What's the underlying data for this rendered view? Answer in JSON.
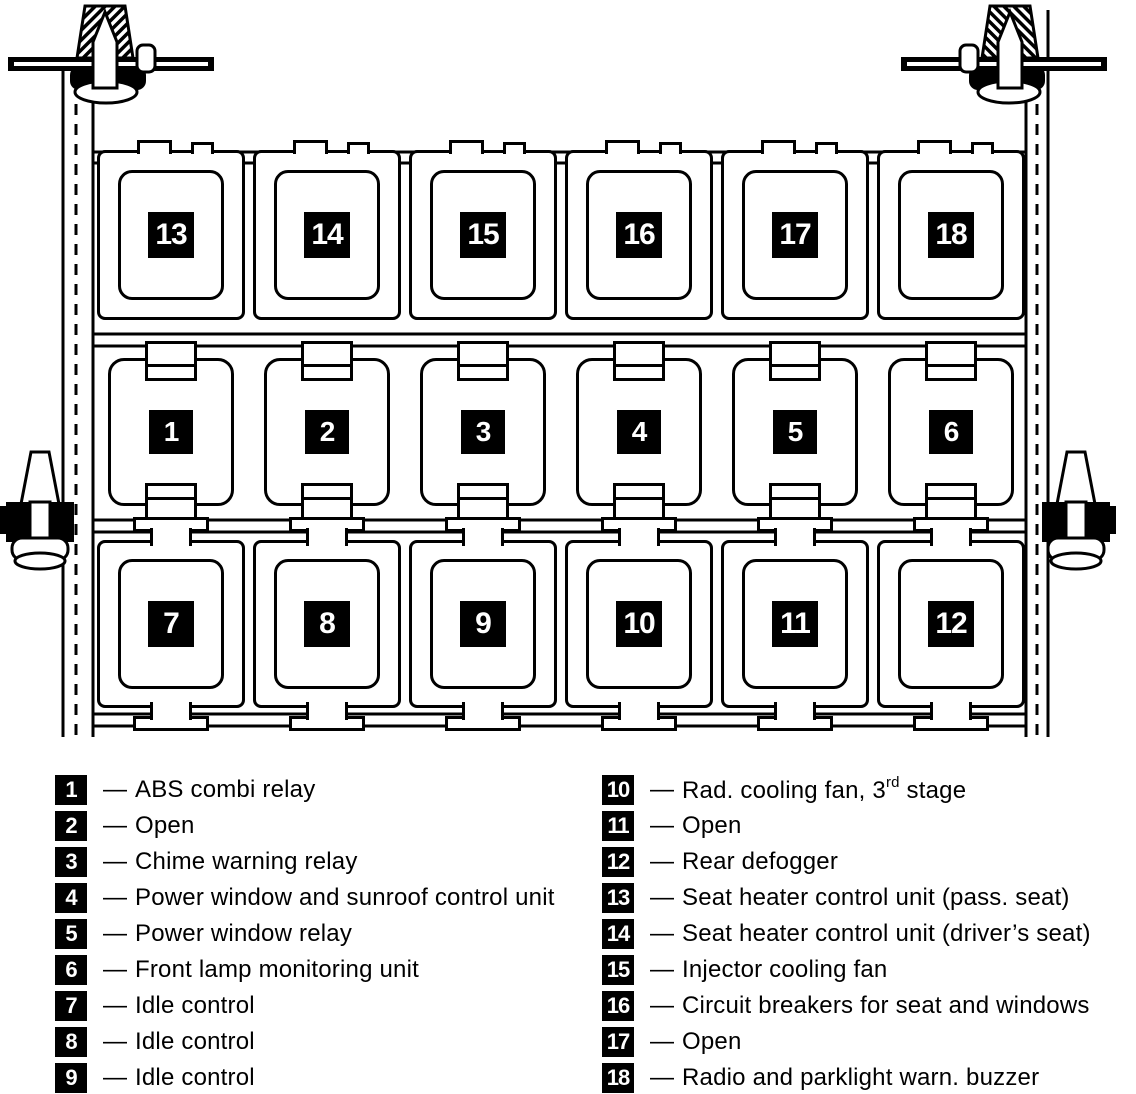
{
  "diagram": {
    "rows": [
      {
        "id": "top-row",
        "numbers": [
          "13",
          "14",
          "15",
          "16",
          "17",
          "18"
        ]
      },
      {
        "id": "middle-row",
        "numbers": [
          "1",
          "2",
          "3",
          "4",
          "5",
          "6"
        ]
      },
      {
        "id": "bottom-row",
        "numbers": [
          "7",
          "8",
          "9",
          "10",
          "11",
          "12"
        ]
      }
    ]
  },
  "legend": {
    "dash": "—",
    "columns": [
      {
        "items": [
          {
            "num": "1",
            "label": "ABS combi relay"
          },
          {
            "num": "2",
            "label": "Open"
          },
          {
            "num": "3",
            "label": "Chime warning relay"
          },
          {
            "num": "4",
            "label": "Power window and sunroof control unit"
          },
          {
            "num": "5",
            "label": "Power window relay"
          },
          {
            "num": "6",
            "label": "Front lamp monitoring unit"
          },
          {
            "num": "7",
            "label": "Idle control"
          },
          {
            "num": "8",
            "label": "Idle control"
          },
          {
            "num": "9",
            "label": "Idle control"
          }
        ]
      },
      {
        "items": [
          {
            "num": "10",
            "pre": "Rad. cooling fan, 3",
            "sup": "rd",
            "post": " stage"
          },
          {
            "num": "11",
            "label": "Open"
          },
          {
            "num": "12",
            "label": "Rear defogger"
          },
          {
            "num": "13",
            "label": "Seat heater control unit (pass. seat)"
          },
          {
            "num": "14",
            "label": "Seat heater control unit (driver’s seat)"
          },
          {
            "num": "15",
            "label": "Injector cooling fan"
          },
          {
            "num": "16",
            "label": "Circuit breakers for seat and windows"
          },
          {
            "num": "17",
            "label": "Open"
          },
          {
            "num": "18",
            "label": "Radio and parklight warn. buzzer"
          }
        ]
      }
    ]
  },
  "colors": {
    "ink": "#000000",
    "paper": "#ffffff"
  }
}
